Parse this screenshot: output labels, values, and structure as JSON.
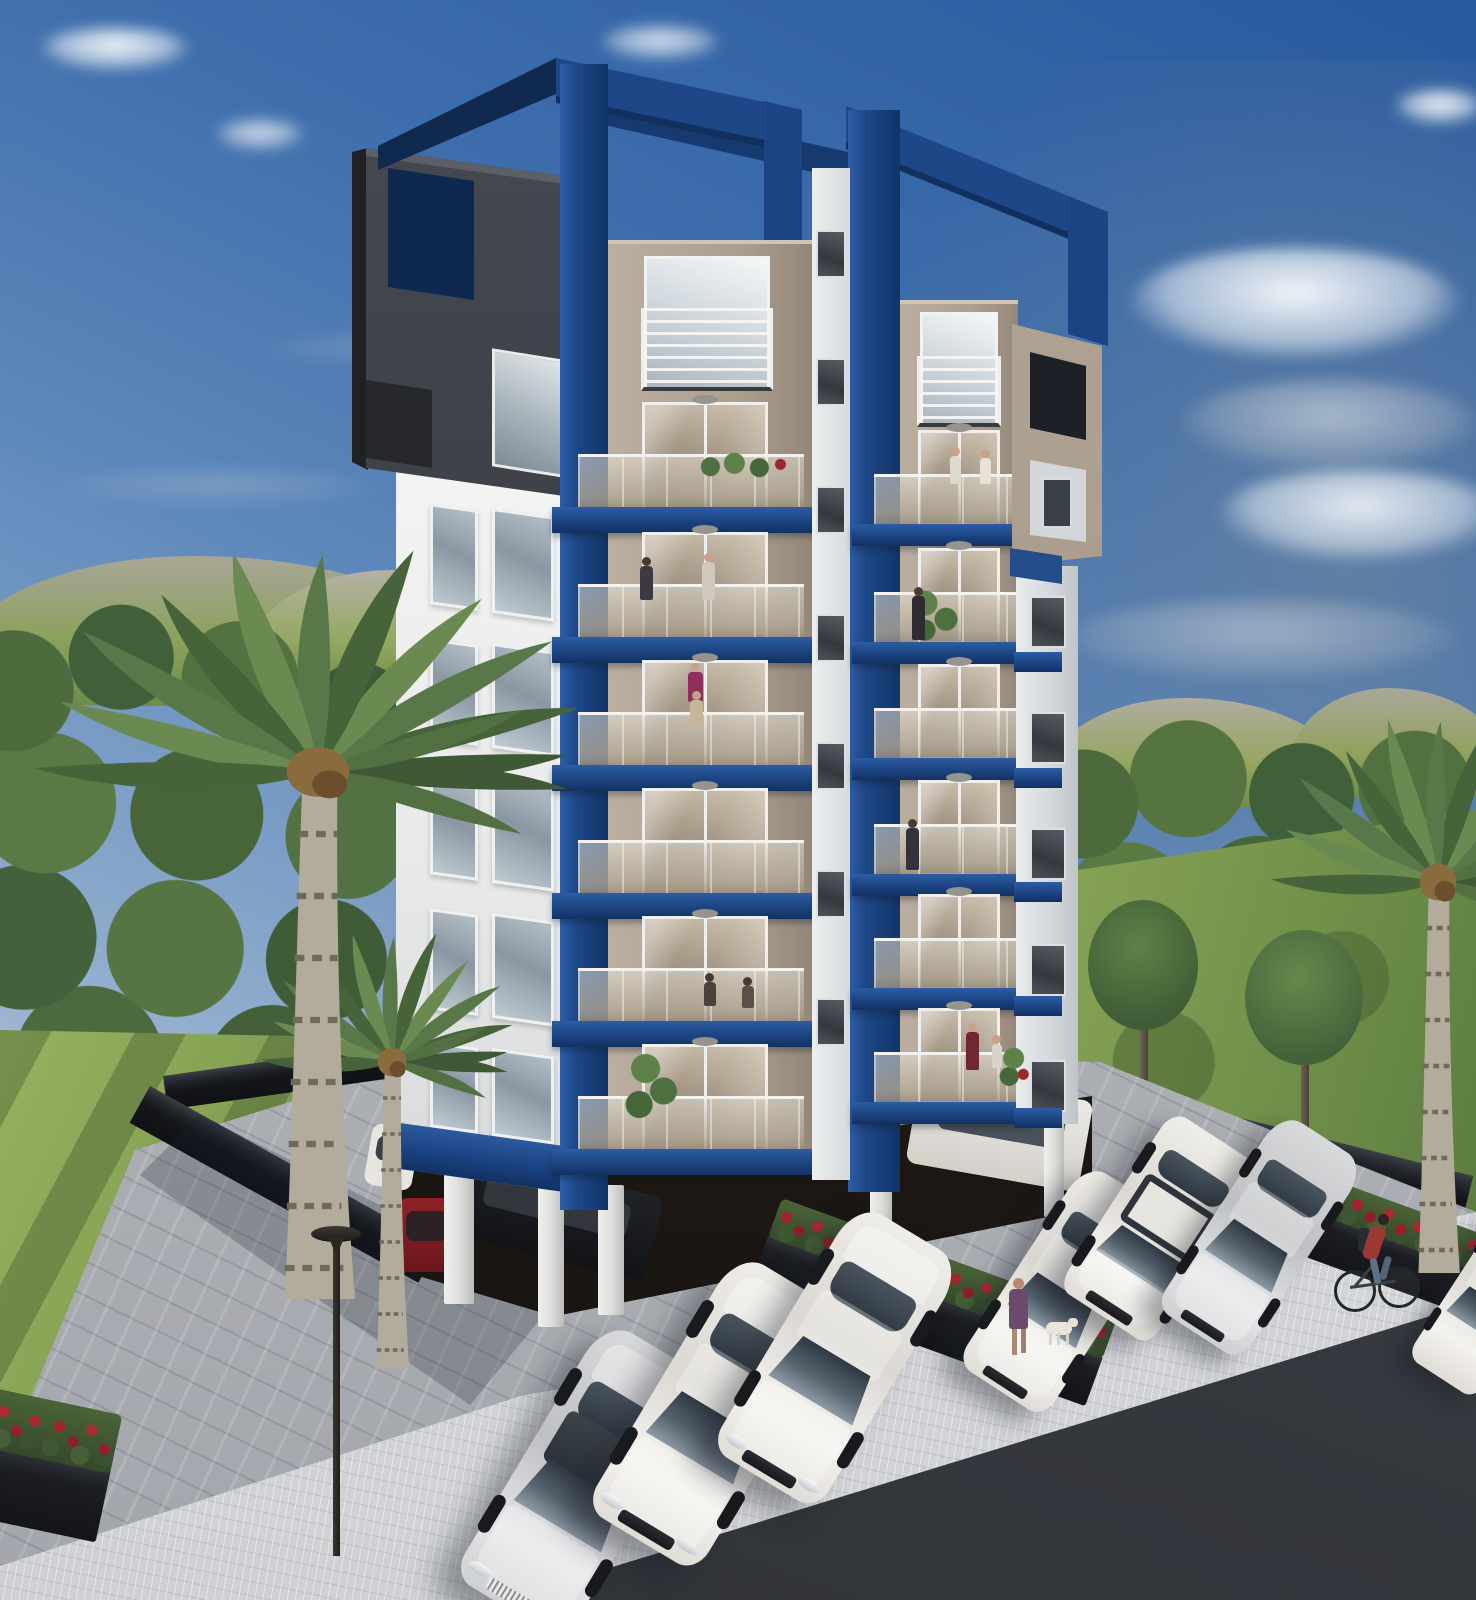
{
  "scene": {
    "title": "Modern apartment building – exterior 3D render",
    "setting": "Daytime architectural visualization: eight-story white, taupe and navy-blue apartment tower with stacked glass balconies, rooftop blue portal frames, ground-floor pilotis parking, paved forecourt with parked cars, palm trees, lawns, distant wooded hills and a partly cloudy blue sky",
    "aria": {
      "sky": "Blue sky with scattered white clouds, greyer toward the right horizon",
      "landscape": "Green lawns, tree lines and rocky green hills behind the property",
      "building": "Eight-story apartment building with white side wall, taupe balcony towers, navy-blue vertical bands, blue balcony slabs and rooftop portal frames",
      "side_wall": "White side facade with two columns of windows and a dark louver strip",
      "charcoal_box": "Dark charcoal corner volume crowning the left top floors",
      "left_tower": "Left balcony tower: six glass balconies with blue slabs and a railed top window",
      "right_tower": "Right balcony tower: six glass balconies with blue slabs and a railed top window",
      "parking": "Paved parking forecourt with six parked cars and more cars under the pilotis",
      "planters": "Black planter boxes full of red flowers",
      "street": "Light paved sidewalk and dark asphalt road in the foreground",
      "palm": "Tall palm tree in the left foreground",
      "lamp": "Modern black street lamp",
      "woman_dog": "Woman in a purple dress walking a small white dog",
      "cyclist": "Man in a red shirt with a backpack riding a bicycle on the sidewalk"
    },
    "palette": {
      "navy_blue": "#1d4787",
      "navy_dark": "#123162",
      "taupe_facade": "#b5a899",
      "white_wall": "#ececec",
      "charcoal": "#3a3d44",
      "sky_top": "#27599e",
      "sky_horizon": "#c9d6e3",
      "lawn": "#7d9b4f",
      "tree_green": "#4c6a3c",
      "paver_grey": "#b0b3b8",
      "sidewalk": "#d4d6d9",
      "asphalt": "#3b3e43",
      "wall_black": "#15171b",
      "flower_red": "#a5242c"
    },
    "building": {
      "stories_visible": 8,
      "balcony_towers": 2,
      "balconies_per_tower": 6,
      "features": [
        "rooftop blue portal frames",
        "charcoal corner box",
        "glass balustrade balconies",
        "blue slab fascias",
        "pilotis parking level",
        "louvered side strip",
        "taupe right-side box volume"
      ]
    },
    "vehicles": [
      {
        "type": "sedan",
        "color": "silver",
        "location": "front parking row"
      },
      {
        "type": "sedan",
        "color": "white",
        "location": "front parking row"
      },
      {
        "type": "sedan",
        "color": "white",
        "location": "front parking row"
      },
      {
        "type": "sedan",
        "color": "white",
        "location": "right parking row"
      },
      {
        "type": "boxy SUV",
        "color": "white",
        "location": "right parking row"
      },
      {
        "type": "sedan",
        "color": "silver-white",
        "location": "right parking row"
      },
      {
        "type": "sedan",
        "color": "white",
        "location": "far right edge, partially visible"
      },
      {
        "type": "sedan",
        "color": "black",
        "location": "under building pilotis"
      },
      {
        "type": "hatchback",
        "color": "dark red",
        "location": "under building pilotis"
      },
      {
        "type": "van",
        "color": "white",
        "location": "under building pilotis, right"
      }
    ],
    "people": [
      {
        "who": "woman in purple dress",
        "activity": "walking a white dog near the planter"
      },
      {
        "who": "man in red shirt with backpack",
        "activity": "riding a bicycle on the sidewalk"
      },
      {
        "who": "residents",
        "activity": "standing on several balconies"
      }
    ],
    "vegetation": {
      "palms": 3,
      "balcony_plants": 5,
      "flower_planters": 3,
      "background": "dense tree line with rocky green hills"
    }
  }
}
